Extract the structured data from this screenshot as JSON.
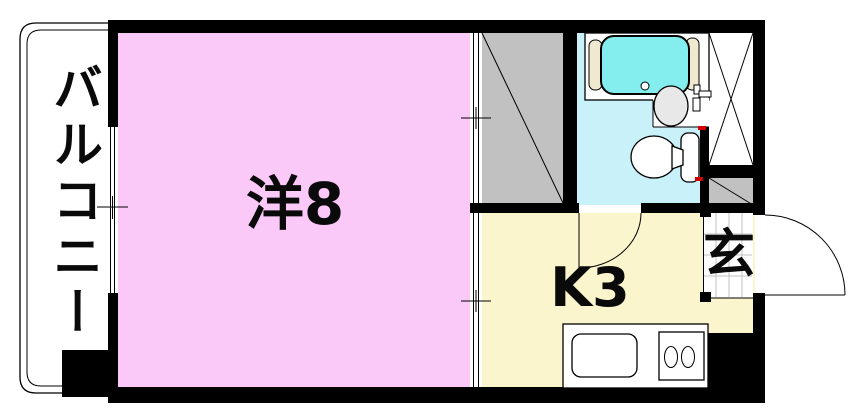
{
  "plan": {
    "type": "floor-plan",
    "rooms": {
      "balcony": {
        "label": "バルコニー"
      },
      "western_room": {
        "label": "洋8"
      },
      "kitchen": {
        "label": "K3"
      },
      "entrance": {
        "label": "玄"
      }
    },
    "colors": {
      "wall": "#000000",
      "line": "#000000",
      "bg": "#ffffff",
      "room_pink": "#fbc9f8",
      "kitchen_yellow": "#faf5cc",
      "bath_blue": "#c9f1f9",
      "tub_cyan": "#84eded",
      "closet_gray": "#c1c1c1",
      "fixture_gray": "#e8e8e8",
      "pad_cream": "#efe9d0",
      "tile_line": "#c0c0c0",
      "red_mark": "#d00000"
    }
  }
}
